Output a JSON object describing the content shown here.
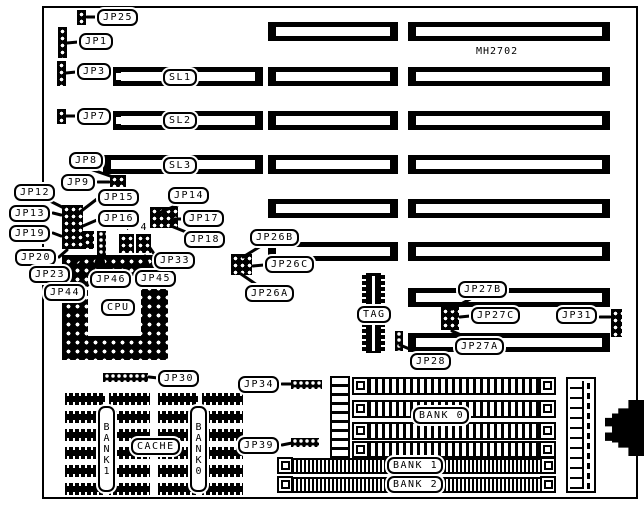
{
  "board": {
    "ink": "#000000",
    "background": "#ffffff",
    "silkscreen_model": "MH2702"
  },
  "callouts": {
    "JP25": "JP25",
    "JP1": "JP1",
    "JP3": "JP3",
    "JP7": "JP7",
    "JP8": "JP8",
    "JP9": "JP9",
    "JP12": "JP12",
    "JP13": "JP13",
    "JP19": "JP19",
    "JP15": "JP15",
    "JP16": "JP16",
    "JP14": "JP14",
    "JP17": "JP17",
    "JP18": "JP18",
    "JP20": "JP20",
    "JP23": "JP23",
    "JP44": "JP44",
    "JP46": "JP46",
    "JP45": "JP45",
    "JP33": "JP33",
    "JP26B": "JP26B",
    "JP26C": "JP26C",
    "JP26A": "JP26A",
    "JP30": "JP30",
    "JP34": "JP34",
    "JP39": "JP39",
    "JP27B": "JP27B",
    "JP27C": "JP27C",
    "JP27A": "JP27A",
    "JP28": "JP28",
    "JP31": "JP31"
  },
  "slots": {
    "SL1": "SL1",
    "SL2": "SL2",
    "SL3": "SL3"
  },
  "chips": {
    "cpu": "CPU",
    "tag": "TAG"
  },
  "memory": {
    "bank0": "BANK 0",
    "bank1": "BANK 1",
    "bank2": "BANK 2",
    "cache": "CACHE",
    "cache_bank1_vertical": "BANK1",
    "cache_bank0_vertical": "BANK0"
  },
  "annotations": {
    "pin4_left": "4",
    "pin4_right": "4"
  }
}
